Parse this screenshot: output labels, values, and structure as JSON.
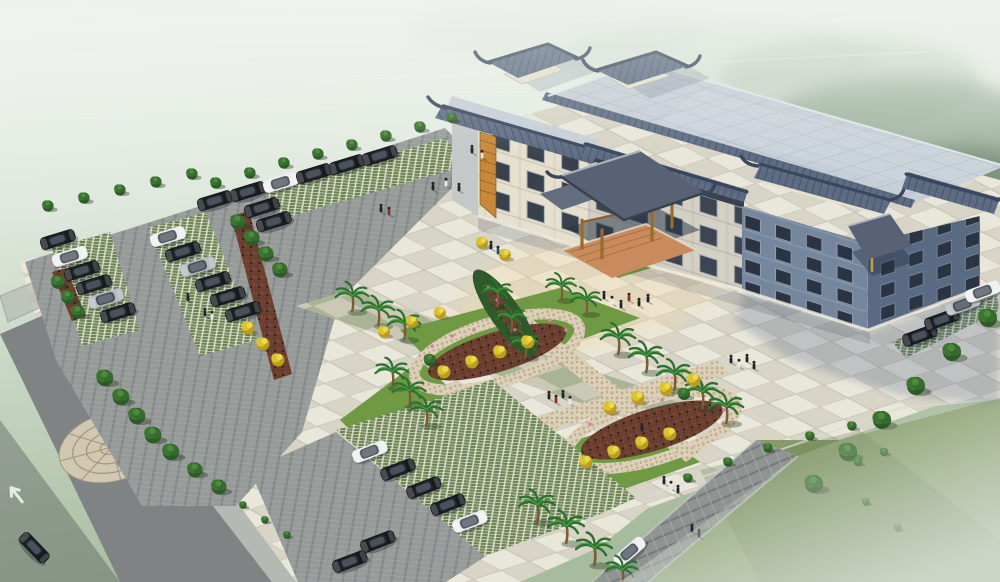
{
  "meta": {
    "kind": "architectural aerial rendering",
    "subject": "Chinese-style civic building with forecourt plaza, landscaped gardens, parking lots and access roads",
    "atmosphere": "soft morning haze over forested hills, no visible text in image"
  },
  "palette": {
    "fog_top": "#eaf0e9",
    "fog_mid": "#d3dfd1",
    "fog_low": "#b9c8ae",
    "forest_green": "#4a6a4c",
    "field_green": "#7d9160",
    "field_green_light": "#95a77f",
    "lawn_green": "#6f9a43",
    "tree_green": "#36652c",
    "yellow_tree": "#d9c32e",
    "palm_green": "#2e7030",
    "palm_trunk": "#7a5c38",
    "mulch_brown": "#6b4030",
    "flower_pink": "#d77fae",
    "plaza_tile_light": "#e9e6da",
    "plaza_tile_dark": "#d8d4c6",
    "plaza_green_tile": "#a9b496",
    "plaza_green_tile_alt": "#ccc8b6",
    "paver_green": "#6d8352",
    "paver_line": "#e8ebe0",
    "asphalt": "#979b9a",
    "asphalt_dark": "#7f8384",
    "sidewalk": "#b5b9b4",
    "stone_tan": "#d6ccb6",
    "stone_line": "#a5947a",
    "pebble_path": "#dcd0b8",
    "rock_gray": "#8f9392",
    "roof_flat": "#c6cfd7",
    "roof_grid": "#aeb9c2",
    "roof_tile_blue": "#5f6d84",
    "roof_tile_dark": "#46566b",
    "roof_ridge": "#39465c",
    "canopy_slate": "#596274",
    "facade_cream": "#e6e0cf",
    "facade_side": "#c4c8c9",
    "facade_blue": "#75869d",
    "facade_blue_dark": "#5a6a82",
    "window_dark": "#39414d",
    "window_deep": "#2a3442",
    "wood_orange": "#c8883a",
    "wood_beam": "#9a6a2f",
    "terracotta": "#c98a5e",
    "car_black": "#16191e",
    "car_white": "#edeff1",
    "car_silver": "#b6bbc1",
    "shadow_blue": "#4a5f82"
  },
  "building": {
    "wings": 3,
    "floors_left_wing": 3,
    "floors_right_wing": 4,
    "rooftop_pavilions": 2,
    "entrance_canopies": 2,
    "roof_style": "traditional Chinese tiled eaves and corner pavilions over a flat grey tiled roof",
    "facade": "cream stone with dark glazing and orange timber lattice panels"
  },
  "site": {
    "plaza_paving": "checkerboard tile forecourt with lawn inlays",
    "garden_paths": "X-shaped pebble walks looping around two leaf-shaped planting beds",
    "parking_areas": [
      "west lot",
      "south lot",
      "east strip"
    ],
    "road_marking": "straight-ahead lane arrow on southwest access road",
    "decorative_paving": "circular flagstone medallion at southwest walk"
  },
  "counts": {
    "cars_total": 33,
    "cars_black": 23,
    "cars_white": 7,
    "cars_silver": 3,
    "people": 32,
    "palm_trees": 20,
    "golden_trees": 20,
    "green_trees_and_shrubs": 47
  },
  "scene": {
    "cars": [
      {
        "x": 215,
        "y": 201,
        "r": -17,
        "c": "black"
      },
      {
        "x": 248,
        "y": 192,
        "r": -17,
        "c": "black"
      },
      {
        "x": 281,
        "y": 183,
        "r": -17,
        "c": "white"
      },
      {
        "x": 314,
        "y": 174,
        "r": -17,
        "c": "black"
      },
      {
        "x": 347,
        "y": 165,
        "r": -17,
        "c": "black"
      },
      {
        "x": 380,
        "y": 156,
        "r": -17,
        "c": "black"
      },
      {
        "x": 262,
        "y": 208,
        "r": -17,
        "c": "black"
      },
      {
        "x": 274,
        "y": 222,
        "r": -17,
        "c": "black"
      },
      {
        "x": 70,
        "y": 257,
        "r": -17,
        "c": "white"
      },
      {
        "x": 82,
        "y": 271,
        "r": -17,
        "c": "black"
      },
      {
        "x": 94,
        "y": 285,
        "r": -17,
        "c": "black"
      },
      {
        "x": 106,
        "y": 299,
        "r": -17,
        "c": "silver"
      },
      {
        "x": 118,
        "y": 313,
        "r": -17,
        "c": "black"
      },
      {
        "x": 168,
        "y": 237,
        "r": -17,
        "c": "white"
      },
      {
        "x": 183,
        "y": 252,
        "r": -17,
        "c": "black"
      },
      {
        "x": 198,
        "y": 267,
        "r": -17,
        "c": "silver"
      },
      {
        "x": 213,
        "y": 282,
        "r": -17,
        "c": "black"
      },
      {
        "x": 228,
        "y": 297,
        "r": -17,
        "c": "black"
      },
      {
        "x": 243,
        "y": 312,
        "r": -17,
        "c": "black"
      },
      {
        "x": 58,
        "y": 240,
        "r": -17,
        "c": "black"
      },
      {
        "x": 920,
        "y": 336,
        "r": -20,
        "c": "black"
      },
      {
        "x": 942,
        "y": 320,
        "r": -20,
        "c": "black"
      },
      {
        "x": 963,
        "y": 305,
        "r": -20,
        "c": "silver"
      },
      {
        "x": 983,
        "y": 292,
        "r": -20,
        "c": "white"
      },
      {
        "x": 370,
        "y": 452,
        "r": -21,
        "c": "white"
      },
      {
        "x": 398,
        "y": 470,
        "r": -21,
        "c": "black"
      },
      {
        "x": 424,
        "y": 488,
        "r": -21,
        "c": "black"
      },
      {
        "x": 448,
        "y": 505,
        "r": -21,
        "c": "black"
      },
      {
        "x": 470,
        "y": 522,
        "r": -21,
        "c": "white"
      },
      {
        "x": 378,
        "y": 542,
        "r": -21,
        "c": "black"
      },
      {
        "x": 350,
        "y": 562,
        "r": -21,
        "c": "black"
      },
      {
        "x": 34,
        "y": 548,
        "r": 46,
        "c": "black"
      },
      {
        "x": 630,
        "y": 552,
        "r": -41,
        "c": "white"
      }
    ],
    "plants": [
      {
        "t": "bush",
        "x": 48,
        "y": 206,
        "s": 1.2
      },
      {
        "t": "bush",
        "x": 84,
        "y": 198,
        "s": 1.2
      },
      {
        "t": "bush",
        "x": 120,
        "y": 190,
        "s": 1.2
      },
      {
        "t": "bush",
        "x": 156,
        "y": 182,
        "s": 1.2
      },
      {
        "t": "bush",
        "x": 192,
        "y": 174,
        "s": 1.2
      },
      {
        "t": "bush",
        "x": 216,
        "y": 183,
        "s": 1.2
      },
      {
        "t": "bush",
        "x": 250,
        "y": 173,
        "s": 1.2
      },
      {
        "t": "bush",
        "x": 284,
        "y": 163,
        "s": 1.2
      },
      {
        "t": "bush",
        "x": 318,
        "y": 154,
        "s": 1.2
      },
      {
        "t": "bush",
        "x": 352,
        "y": 145,
        "s": 1.2
      },
      {
        "t": "bush",
        "x": 386,
        "y": 136,
        "s": 1.2
      },
      {
        "t": "bush",
        "x": 420,
        "y": 127,
        "s": 1.2
      },
      {
        "t": "bush",
        "x": 452,
        "y": 118,
        "s": 1.1
      },
      {
        "t": "tree",
        "x": 238,
        "y": 222,
        "s": 1.0
      },
      {
        "t": "tree",
        "x": 252,
        "y": 238,
        "s": 1.0
      },
      {
        "t": "tree",
        "x": 266,
        "y": 254,
        "s": 1.0
      },
      {
        "t": "tree",
        "x": 280,
        "y": 270,
        "s": 1.0
      },
      {
        "t": "tree",
        "x": 58,
        "y": 282,
        "s": 0.9
      },
      {
        "t": "tree",
        "x": 68,
        "y": 297,
        "s": 0.9
      },
      {
        "t": "tree",
        "x": 78,
        "y": 312,
        "s": 0.9
      },
      {
        "t": "ytree",
        "x": 248,
        "y": 328,
        "s": 1.0
      },
      {
        "t": "ytree",
        "x": 263,
        "y": 344,
        "s": 1.0
      },
      {
        "t": "ytree",
        "x": 278,
        "y": 360,
        "s": 1.0
      },
      {
        "t": "tree",
        "x": 105,
        "y": 378,
        "s": 1.1
      },
      {
        "t": "tree",
        "x": 121,
        "y": 397,
        "s": 1.1
      },
      {
        "t": "tree",
        "x": 137,
        "y": 416,
        "s": 1.1
      },
      {
        "t": "tree",
        "x": 153,
        "y": 435,
        "s": 1.1
      },
      {
        "t": "tree",
        "x": 171,
        "y": 452,
        "s": 1.1
      },
      {
        "t": "tree",
        "x": 195,
        "y": 470,
        "s": 1.0
      },
      {
        "t": "tree",
        "x": 219,
        "y": 487,
        "s": 1.0
      },
      {
        "t": "bush",
        "x": 243,
        "y": 505,
        "s": 0.8
      },
      {
        "t": "bush",
        "x": 265,
        "y": 520,
        "s": 0.8
      },
      {
        "t": "bush",
        "x": 287,
        "y": 535,
        "s": 0.8
      },
      {
        "t": "palm",
        "x": 352,
        "y": 296,
        "s": 1.1
      },
      {
        "t": "palm",
        "x": 378,
        "y": 310,
        "s": 1.1
      },
      {
        "t": "palm",
        "x": 404,
        "y": 324,
        "s": 1.1
      },
      {
        "t": "palm",
        "x": 392,
        "y": 372,
        "s": 1.1
      },
      {
        "t": "palm",
        "x": 409,
        "y": 391,
        "s": 1.1
      },
      {
        "t": "palm",
        "x": 426,
        "y": 410,
        "s": 1.1
      },
      {
        "t": "palm",
        "x": 618,
        "y": 338,
        "s": 1.15
      },
      {
        "t": "palm",
        "x": 646,
        "y": 356,
        "s": 1.15
      },
      {
        "t": "palm",
        "x": 674,
        "y": 374,
        "s": 1.15
      },
      {
        "t": "palm",
        "x": 702,
        "y": 392,
        "s": 1.15
      },
      {
        "t": "palm",
        "x": 726,
        "y": 407,
        "s": 1.15
      },
      {
        "t": "palm",
        "x": 561,
        "y": 286,
        "s": 1.0
      },
      {
        "t": "palm",
        "x": 586,
        "y": 300,
        "s": 1.0
      },
      {
        "t": "palm",
        "x": 497,
        "y": 292,
        "s": 1.0
      },
      {
        "t": "palm",
        "x": 511,
        "y": 318,
        "s": 1.0
      },
      {
        "t": "palm",
        "x": 525,
        "y": 344,
        "s": 1.0
      },
      {
        "t": "palm",
        "x": 537,
        "y": 505,
        "s": 1.2
      },
      {
        "t": "palm",
        "x": 566,
        "y": 526,
        "s": 1.2
      },
      {
        "t": "palm",
        "x": 594,
        "y": 548,
        "s": 1.2
      },
      {
        "t": "palm",
        "x": 622,
        "y": 570,
        "s": 1.1
      },
      {
        "t": "ytree",
        "x": 444,
        "y": 372,
        "s": 1.0
      },
      {
        "t": "ytree",
        "x": 472,
        "y": 362,
        "s": 1.0
      },
      {
        "t": "ytree",
        "x": 500,
        "y": 352,
        "s": 1.0
      },
      {
        "t": "ytree",
        "x": 528,
        "y": 342,
        "s": 1.0
      },
      {
        "t": "ytree",
        "x": 384,
        "y": 332,
        "s": 0.9
      },
      {
        "t": "ytree",
        "x": 412,
        "y": 322,
        "s": 0.9
      },
      {
        "t": "ytree",
        "x": 440,
        "y": 313,
        "s": 0.9
      },
      {
        "t": "ytree",
        "x": 610,
        "y": 408,
        "s": 1.0
      },
      {
        "t": "ytree",
        "x": 638,
        "y": 398,
        "s": 1.0
      },
      {
        "t": "ytree",
        "x": 666,
        "y": 389,
        "s": 1.0
      },
      {
        "t": "ytree",
        "x": 694,
        "y": 380,
        "s": 1.0
      },
      {
        "t": "ytree",
        "x": 586,
        "y": 462,
        "s": 1.0
      },
      {
        "t": "ytree",
        "x": 614,
        "y": 452,
        "s": 1.0
      },
      {
        "t": "ytree",
        "x": 642,
        "y": 443,
        "s": 1.0
      },
      {
        "t": "ytree",
        "x": 670,
        "y": 434,
        "s": 1.0
      },
      {
        "t": "ytree",
        "x": 482,
        "y": 243,
        "s": 0.9
      },
      {
        "t": "ytree",
        "x": 505,
        "y": 255,
        "s": 0.9
      },
      {
        "t": "tree",
        "x": 430,
        "y": 360,
        "s": 0.8
      },
      {
        "t": "tree",
        "x": 684,
        "y": 394,
        "s": 0.8
      },
      {
        "t": "tree",
        "x": 988,
        "y": 318,
        "s": 1.2
      },
      {
        "t": "tree",
        "x": 952,
        "y": 352,
        "s": 1.2
      },
      {
        "t": "tree",
        "x": 916,
        "y": 386,
        "s": 1.2
      },
      {
        "t": "tree",
        "x": 882,
        "y": 420,
        "s": 1.2
      },
      {
        "t": "tree",
        "x": 848,
        "y": 452,
        "s": 1.2
      },
      {
        "t": "tree",
        "x": 814,
        "y": 484,
        "s": 1.2
      },
      {
        "t": "bush",
        "x": 866,
        "y": 502,
        "s": 0.8
      },
      {
        "t": "bush",
        "x": 898,
        "y": 528,
        "s": 0.8
      },
      {
        "t": "bush",
        "x": 688,
        "y": 478,
        "s": 1.0
      },
      {
        "t": "bush",
        "x": 728,
        "y": 462,
        "s": 1.0
      },
      {
        "t": "bush",
        "x": 768,
        "y": 448,
        "s": 1.0
      },
      {
        "t": "bush",
        "x": 810,
        "y": 436,
        "s": 1.0
      },
      {
        "t": "bush",
        "x": 852,
        "y": 426,
        "s": 1.0
      },
      {
        "t": "bush",
        "x": 858,
        "y": 462,
        "s": 0.9
      },
      {
        "t": "bush",
        "x": 884,
        "y": 452,
        "s": 0.9
      }
    ],
    "people": [
      {
        "x": 433,
        "y": 190,
        "c": "#1f242c"
      },
      {
        "x": 446,
        "y": 186,
        "c": "#e8e8ea"
      },
      {
        "x": 459,
        "y": 191,
        "c": "#1f242c"
      },
      {
        "x": 381,
        "y": 212,
        "c": "#1f242c"
      },
      {
        "x": 389,
        "y": 215,
        "c": "#8a3030"
      },
      {
        "x": 472,
        "y": 153,
        "c": "#1f242c"
      },
      {
        "x": 482,
        "y": 158,
        "c": "#e8e8ea"
      },
      {
        "x": 491,
        "y": 249,
        "c": "#1f242c"
      },
      {
        "x": 498,
        "y": 254,
        "c": "#2e4a7a"
      },
      {
        "x": 604,
        "y": 299,
        "c": "#1f242c"
      },
      {
        "x": 612,
        "y": 304,
        "c": "#e8e8ea"
      },
      {
        "x": 621,
        "y": 308,
        "c": "#1f242c"
      },
      {
        "x": 629,
        "y": 301,
        "c": "#8a3030"
      },
      {
        "x": 639,
        "y": 306,
        "c": "#1f242c"
      },
      {
        "x": 648,
        "y": 302,
        "c": "#1f242c"
      },
      {
        "x": 731,
        "y": 363,
        "c": "#1f242c"
      },
      {
        "x": 739,
        "y": 367,
        "c": "#e8e8ea"
      },
      {
        "x": 747,
        "y": 362,
        "c": "#1f242c"
      },
      {
        "x": 754,
        "y": 369,
        "c": "#1f242c"
      },
      {
        "x": 188,
        "y": 301,
        "c": "#1f242c"
      },
      {
        "x": 205,
        "y": 316,
        "c": "#1f242c"
      },
      {
        "x": 212,
        "y": 319,
        "c": "#e8e8ea"
      },
      {
        "x": 549,
        "y": 399,
        "c": "#1f242c"
      },
      {
        "x": 556,
        "y": 403,
        "c": "#8a3030"
      },
      {
        "x": 563,
        "y": 398,
        "c": "#1f242c"
      },
      {
        "x": 570,
        "y": 404,
        "c": "#e8e8ea"
      },
      {
        "x": 642,
        "y": 431,
        "c": "#1f242c"
      },
      {
        "x": 664,
        "y": 484,
        "c": "#1f242c"
      },
      {
        "x": 671,
        "y": 489,
        "c": "#e8e8ea"
      },
      {
        "x": 678,
        "y": 493,
        "c": "#1f242c"
      },
      {
        "x": 692,
        "y": 532,
        "c": "#1f242c"
      },
      {
        "x": 699,
        "y": 537,
        "c": "#1f242c"
      }
    ]
  }
}
